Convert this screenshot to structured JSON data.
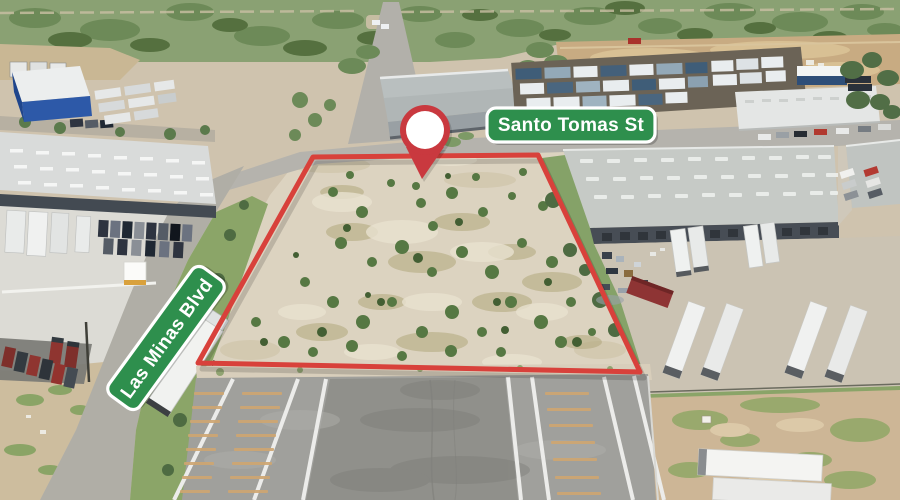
{
  "annotations": {
    "property_boundary": {
      "color": "#d8413b"
    },
    "location_pin": {
      "icon": "map-pin-icon",
      "ring_color": "#c9393f",
      "fill_color": "#ffffff"
    },
    "street_signs": [
      {
        "id": "santo-tomas",
        "label": "Santo Tomas St"
      },
      {
        "id": "las-minas",
        "label": "Las Minas Blvd"
      }
    ],
    "sign_style": {
      "background": "#2e8f4d",
      "border": "#ffffff",
      "text_color": "#ffffff"
    }
  }
}
